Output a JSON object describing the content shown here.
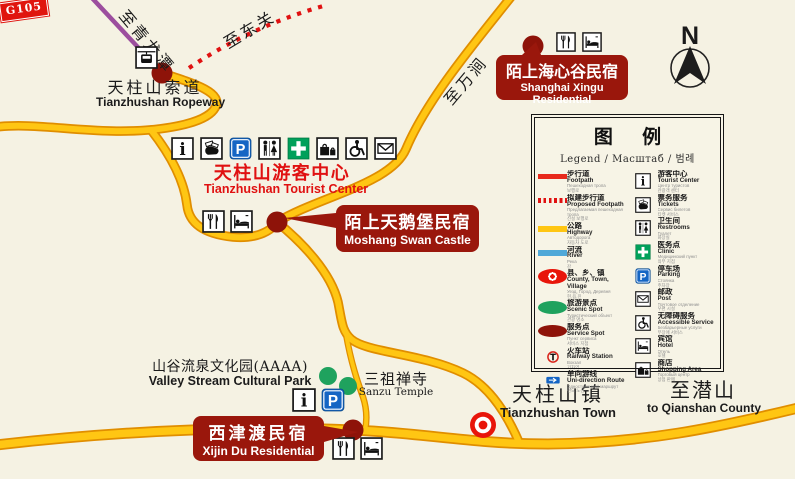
{
  "map": {
    "background_color": "#F5F2E3",
    "road_color": "#FFC613",
    "road_edge_color": "#E08E00",
    "footpath_color": "#E01111",
    "river_color": "#4FA8D8",
    "ropeway_line_color": "#9C4E9E",
    "callout_color": "#9A170C",
    "compass_label": "N"
  },
  "labels": {
    "to_qinglongtan": "至青龙潭",
    "to_dongguan": "至东关",
    "to_wanjian": "至万涧",
    "ropeway": {
      "zh": "天柱山索道",
      "en": "Tianzhushan Ropeway"
    },
    "tourist_center": {
      "zh": "天柱山游客中心",
      "en": "Tianzhushan Tourist Center"
    },
    "valley_park": {
      "zh": "山谷流泉文化园(AAAA)",
      "en": "Valley Stream Cultural Park"
    },
    "sanzu_temple": {
      "zh": "三祖禅寺",
      "en": "Sanzu Temple"
    },
    "town": {
      "zh": "天柱山镇",
      "en": "Tianzhushan Town"
    },
    "to_qianshan": {
      "zh": "至潜山",
      "en": "to Qianshan County"
    },
    "route_shield": "G105"
  },
  "callouts": {
    "moshang": {
      "zh": "陌上天鹅堡民宿",
      "en": "Moshang Swan Castle"
    },
    "shanghai": {
      "zh": "陌上海心谷民宿",
      "en": "Shanghai Xingu Residential"
    },
    "xijin": {
      "zh": "西津渡民宿",
      "en": "Xijin Du Residential"
    }
  },
  "facility_strips": {
    "tourist_center": [
      "info",
      "tickets",
      "parking",
      "restrooms",
      "clinic",
      "shopping",
      "wheelchair",
      "mail"
    ],
    "moshang": [
      "restaurant",
      "hotel"
    ],
    "shanghai": [
      "restaurant",
      "hotel"
    ],
    "xijin": [
      "restaurant",
      "hotel"
    ],
    "valley": [
      "info",
      "parking"
    ],
    "ropeway_station": [
      "cablecar"
    ]
  },
  "legend": {
    "title": "图  例",
    "subtitle": "Legend / Масштаб / 범례",
    "left_items": [
      {
        "sample": "footpath",
        "zh": "步行道",
        "en": "Footpath",
        "ru": "Пешеходная тропа",
        "kr": "보행로"
      },
      {
        "sample": "proposed",
        "zh": "拟建步行道",
        "en": "Proposed Footpath",
        "ru": "Предлагаемая пешеходная тропа",
        "kr": "신설 보행로"
      },
      {
        "sample": "highway",
        "zh": "公路",
        "en": "Highway",
        "ru": "Автодорога",
        "kr": "자동차 도로"
      },
      {
        "sample": "river",
        "zh": "河流",
        "en": "River",
        "ru": "Река",
        "kr": "강"
      },
      {
        "sample": "county",
        "zh": "县、乡、镇",
        "en": "County, Town, Village",
        "ru": "Уезд, Город, Деревня",
        "kr": "현,읍,진"
      },
      {
        "sample": "scenic",
        "zh": "旅游景点",
        "en": "Scenic Spot",
        "ru": "Туристический объект",
        "kr": "관광 명소"
      },
      {
        "sample": "service",
        "zh": "服务点",
        "en": "Service Spot",
        "ru": "Пункт сервиса",
        "kr": "서비스 지점"
      },
      {
        "sample": "railway",
        "icon": "railway",
        "zh": "火车站",
        "en": "Railway Station",
        "ru": "Вокзал",
        "kr": "기차역"
      },
      {
        "sample": "unidirection",
        "icon": "arrow",
        "zh": "单向游线",
        "en": "Uni-direction Route",
        "ru": "Односторонний маршрут",
        "kr": "편도 노선"
      }
    ],
    "right_items": [
      {
        "icon": "info",
        "zh": "游客中心",
        "en": "Tourist Center",
        "ru": "Центр туристов",
        "kr": "관광객 센터"
      },
      {
        "icon": "tickets",
        "zh": "票务服务",
        "en": "Tickets",
        "ru": "Сервис билетов",
        "kr": "티켓 서비스"
      },
      {
        "icon": "restrooms",
        "zh": "卫生间",
        "en": "Restrooms",
        "ru": "Туалет",
        "kr": "화장실"
      },
      {
        "icon": "clinic",
        "zh": "医务点",
        "en": "Clinic",
        "ru": "Медицинский пункт",
        "kr": "의무 지점"
      },
      {
        "icon": "parking",
        "zh": "停车场",
        "en": "Parking",
        "ru": "Стоянка",
        "kr": "주차장"
      },
      {
        "icon": "mail",
        "zh": "邮政",
        "en": "Post",
        "ru": "Почтовое отделение",
        "kr": "우편 시설"
      },
      {
        "icon": "wheelchair",
        "zh": "无障碍服务",
        "en": "Accessible Service",
        "ru": "Безбарьерные услуги",
        "kr": "무장애 서비스"
      },
      {
        "icon": "hotel",
        "zh": "宾馆",
        "en": "Hotel",
        "ru": "Отель",
        "kr": "호텔"
      },
      {
        "icon": "shopping",
        "zh": "商店",
        "en": "Shopping Area",
        "ru": "Торговый центр",
        "kr": "상점 판매"
      }
    ]
  }
}
